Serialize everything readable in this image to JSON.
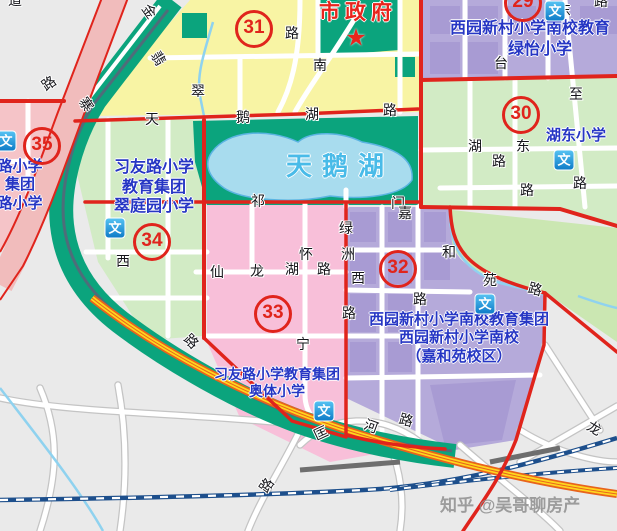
{
  "page_title": "合肥政务区学区地图",
  "watermark": {
    "text": "知乎 @吴哥聊房产"
  },
  "map": {
    "city_hall_label": "市政府",
    "star_glyph": "★",
    "lake_label": "天鹅湖",
    "school_icon_glyph": "文",
    "colors": {
      "boundary_red": "#e0241c",
      "school_text_blue": "#2636c4",
      "district_yellow": "#f8f4a4",
      "district_purple": "#b5aada",
      "district_purple_block": "#a89bd3",
      "district_green": "#d2ebc5",
      "district_pink": "#f8bfd9",
      "district_salmon": "#f5c4c8",
      "park_teal": "#0ba47d",
      "park_light_green": "#cbe7b2",
      "lake_blue": "#a8dcee",
      "highway_pink": "#f1bcbc",
      "highway_yellow": "#ffd61e",
      "highway_orange": "#e8641c",
      "railway_blue": "#1d4f8c",
      "stream_blue": "#8fd2ef"
    },
    "badges": [
      {
        "n": "29",
        "x": 523,
        "y": 3
      },
      {
        "n": "30",
        "x": 521,
        "y": 115
      },
      {
        "n": "31",
        "x": 254,
        "y": 29
      },
      {
        "n": "32",
        "x": 398,
        "y": 269
      },
      {
        "n": "33",
        "x": 273,
        "y": 314
      },
      {
        "n": "34",
        "x": 152,
        "y": 242
      },
      {
        "n": "35",
        "x": 42,
        "y": 146
      }
    ],
    "school_labels": [
      {
        "lines": [
          "西园新村小学南校教育"
        ],
        "cx": 530,
        "y": 19,
        "s": 16
      },
      {
        "lines": [
          "绿怡小学"
        ],
        "cx": 540,
        "y": 40,
        "s": 16
      },
      {
        "lines": [
          "湖东小学"
        ],
        "cx": 576,
        "y": 127,
        "s": 15
      },
      {
        "lines": [
          "习友路小学",
          "教育集团",
          "翠庭园小学"
        ],
        "cx": 154,
        "y": 158,
        "s": 16
      },
      {
        "lines": [
          "西园新村小学南校教育集团",
          "西园新村小学南校",
          "（嘉和苑校区）"
        ],
        "cx": 459,
        "y": 311,
        "s": 15
      },
      {
        "lines": [
          "习友路小学教育集团",
          "奥体小学"
        ],
        "cx": 277,
        "y": 366,
        "s": 14
      },
      {
        "lines": [
          "路小学",
          "集团",
          "路小学"
        ],
        "cx": 20,
        "y": 158,
        "s": 15
      }
    ],
    "wen_icons": [
      {
        "x": 555,
        "y": 11
      },
      {
        "x": 564,
        "y": 160
      },
      {
        "x": 115,
        "y": 228
      },
      {
        "x": 6,
        "y": 141
      },
      {
        "x": 485,
        "y": 304
      },
      {
        "x": 324,
        "y": 411
      }
    ],
    "road_labels": [
      {
        "t": "道",
        "x": 8,
        "y": -7,
        "r": 0
      },
      {
        "t": "路",
        "x": 42,
        "y": 76,
        "r": -35
      },
      {
        "t": "金",
        "x": 142,
        "y": 4,
        "r": 55
      },
      {
        "t": "寨",
        "x": 79,
        "y": 97,
        "r": 55
      },
      {
        "t": "翡",
        "x": 151,
        "y": 51,
        "r": 60
      },
      {
        "t": "翠",
        "x": 191,
        "y": 84,
        "r": 0
      },
      {
        "t": "路",
        "x": 285,
        "y": 26,
        "r": 0
      },
      {
        "t": "南",
        "x": 313,
        "y": 58,
        "r": 0
      },
      {
        "t": "天",
        "x": 145,
        "y": 112,
        "r": 0
      },
      {
        "t": "鹅",
        "x": 236,
        "y": 110,
        "r": 0
      },
      {
        "t": "湖",
        "x": 305,
        "y": 107,
        "r": 0
      },
      {
        "t": "路",
        "x": 383,
        "y": 103,
        "r": 0
      },
      {
        "t": "路",
        "x": 594,
        "y": -6,
        "r": 0
      },
      {
        "t": "东",
        "x": 557,
        "y": 3,
        "r": 0
      },
      {
        "t": "至",
        "x": 569,
        "y": 87,
        "r": 0
      },
      {
        "t": "路",
        "x": 573,
        "y": 176,
        "r": 0
      },
      {
        "t": "台",
        "x": 494,
        "y": 56,
        "r": 0
      },
      {
        "t": "湖",
        "x": 468,
        "y": 139,
        "r": 0
      },
      {
        "t": "东",
        "x": 516,
        "y": 139,
        "r": 0
      },
      {
        "t": "路",
        "x": 492,
        "y": 154,
        "r": 0
      },
      {
        "t": "路",
        "x": 520,
        "y": 183,
        "r": 0
      },
      {
        "t": "祁",
        "x": 251,
        "y": 194,
        "r": 0
      },
      {
        "t": "门",
        "x": 391,
        "y": 196,
        "r": 0
      },
      {
        "t": "嘉",
        "x": 398,
        "y": 206,
        "r": 0
      },
      {
        "t": "和",
        "x": 442,
        "y": 245,
        "r": 0
      },
      {
        "t": "苑",
        "x": 483,
        "y": 273,
        "r": 0
      },
      {
        "t": "路",
        "x": 528,
        "y": 282,
        "r": 15
      },
      {
        "t": "绿",
        "x": 339,
        "y": 221,
        "r": 0
      },
      {
        "t": "洲",
        "x": 341,
        "y": 247,
        "r": 0
      },
      {
        "t": "西",
        "x": 351,
        "y": 271,
        "r": 0
      },
      {
        "t": "路",
        "x": 342,
        "y": 306,
        "r": 0
      },
      {
        "t": "怀",
        "x": 299,
        "y": 247,
        "r": 0
      },
      {
        "t": "宁",
        "x": 296,
        "y": 337,
        "r": 0
      },
      {
        "t": "路",
        "x": 413,
        "y": 292,
        "r": 0
      },
      {
        "t": "仙",
        "x": 210,
        "y": 265,
        "r": 0
      },
      {
        "t": "龙",
        "x": 250,
        "y": 264,
        "r": 0
      },
      {
        "t": "湖",
        "x": 285,
        "y": 262,
        "r": 0
      },
      {
        "t": "路",
        "x": 317,
        "y": 262,
        "r": 0
      },
      {
        "t": "西",
        "x": 116,
        "y": 254,
        "r": 0
      },
      {
        "t": "路",
        "x": 184,
        "y": 334,
        "r": 45
      },
      {
        "t": "路",
        "x": 260,
        "y": 478,
        "r": -55
      },
      {
        "t": "匡",
        "x": 314,
        "y": 426,
        "r": -25
      },
      {
        "t": "河",
        "x": 364,
        "y": 419,
        "r": 20
      },
      {
        "t": "路",
        "x": 399,
        "y": 413,
        "r": 15
      },
      {
        "t": "龙",
        "x": 587,
        "y": 421,
        "r": 30
      }
    ]
  }
}
